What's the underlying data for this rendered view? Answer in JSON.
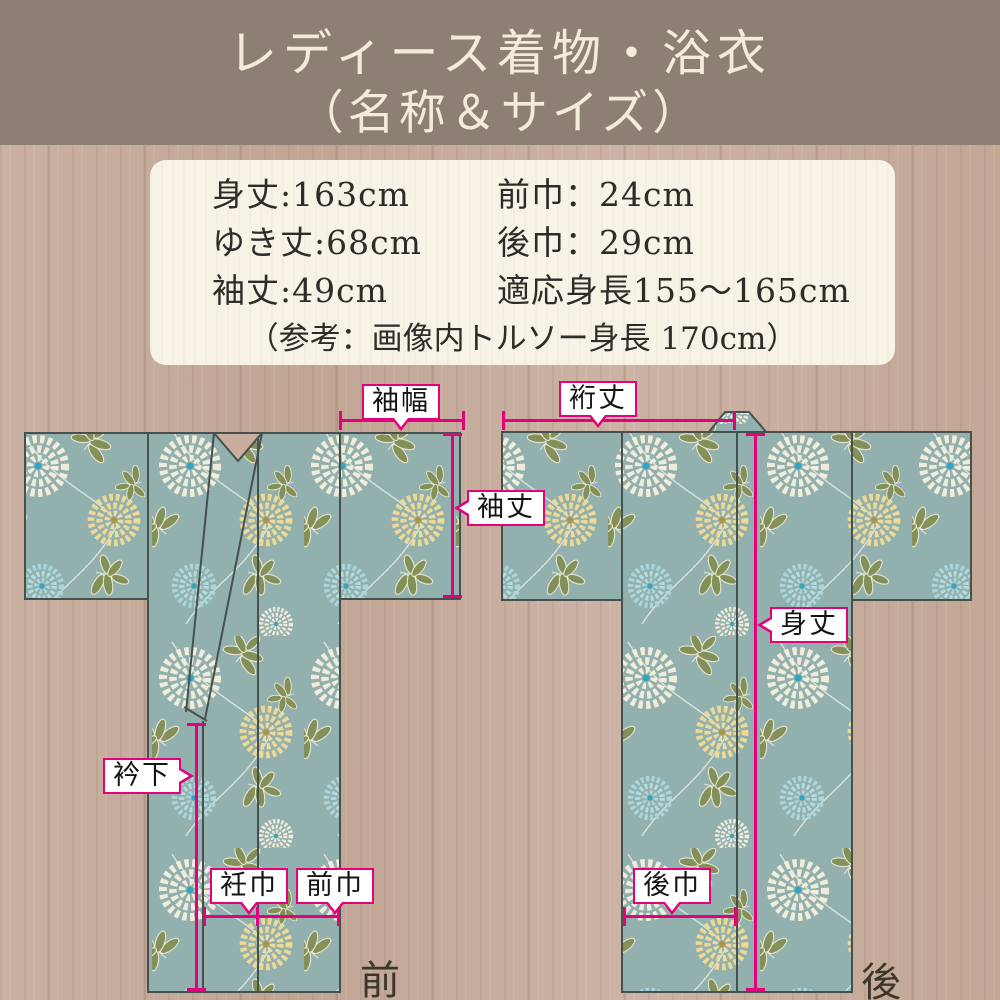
{
  "header": {
    "title_line1": "レディース着物・浴衣",
    "title_line2": "（名称＆サイズ）"
  },
  "specs": {
    "col1": [
      "身丈:163cm",
      "ゆき丈:68cm",
      "袖丈:49cm"
    ],
    "col2": [
      "前巾：24cm",
      "後巾：29cm",
      "適応身長155～165cm"
    ],
    "note": "（参考：画像内トルソー身長 170cm）"
  },
  "diagram": {
    "labels": {
      "sode_haba": "袖幅",
      "yuki_take": "裄丈",
      "sode_take": "袖丈",
      "mitake": "身丈",
      "eri_shita": "衿下",
      "okumi_haba": "衽巾",
      "mae_haba": "前巾",
      "ushiro_haba": "後巾"
    },
    "front_caption": "前",
    "back_caption": "後"
  },
  "colors": {
    "accent_pink": "#e3017c",
    "header_bg": "#8c8074",
    "wood_bg": "#c7ae9f",
    "info_box_bg": "#f8f3e7",
    "fabric_teal": "#92b1ae",
    "outline_dark": "#46504d",
    "flower_white": "#f2edda",
    "flower_yellow": "#eed995",
    "flower_blue": "#abd5da",
    "flower_center_cyan": "#2fa3c0",
    "flower_center_gold": "#b2953b",
    "leaf_olive": "#84905a"
  }
}
